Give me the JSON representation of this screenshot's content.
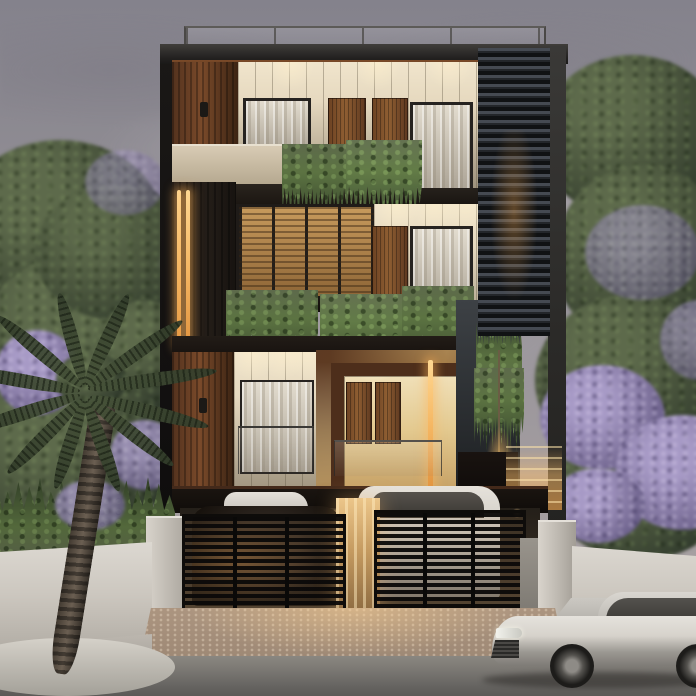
{
  "scene": {
    "type": "3d-architectural-render",
    "time_of_day": "dusk",
    "subject": "Modern three-storey residence with walnut wood panels, cream battened walls and a dark horizontal louver screen; rooftop glass railing; vine-draped balconies with warm interior lighting; gated stilt parking with cars; flanked by a palm tree and purple flowering trees behind a concrete compound wall; a silver sedan parked on the street.",
    "elements": {
      "sky": "overcast mauve dusk sky",
      "building": "modern 3-storey residence",
      "roof_railing": "rooftop glass railing",
      "louver_screen": "dark horizontal louver screen",
      "balcony_vines": "hanging balcony planter vines",
      "wood_feature_box": "walnut entrance box with lit interior",
      "led_strips": "amber vertical LED strip lights",
      "parking_gates": "black slatted driveway gates",
      "parked_cars": "cars inside stilt parking",
      "street_car": "silver sedan parked on street",
      "palm_tree": "palm tree at sidewalk",
      "flowering_trees": "purple flowering trees",
      "compound_wall": "light concrete compound wall",
      "driveway": "paver driveway",
      "street": "asphalt road"
    }
  },
  "colors": {
    "sky-top": "#84828c",
    "sky-mid": "#98949a",
    "sky-low": "#aba4a4",
    "cream": "#e6d9bf",
    "cream-deep": "#b5a78c",
    "wood": "#7a4a2a",
    "wood-dark": "#53321e",
    "wood-deep": "#3c2413",
    "panel-dark": "#221c17",
    "slate": "#3d4145",
    "slate-dark": "#26292c",
    "louver-hi": "#454a52",
    "louver-lo": "#101214",
    "amber": "#f5b763",
    "glow": "#e9a851",
    "frame": "#262320",
    "curtain": "#d3cbbd",
    "vine": "#5c7342",
    "vine-dark": "#34422a",
    "leaf": "#47523b",
    "leaf-dark": "#2d372a",
    "leaf-light": "#5d6a4b",
    "purple": "#8276a0",
    "purple-light": "#a79ac6",
    "concrete": "#ccc7bf",
    "concrete-dark": "#9d9890",
    "paver": "#ac9580",
    "paver-lit": "#d9bf9e",
    "asphalt": "#7d7a75",
    "asphalt-dark": "#5c5a57",
    "car": "#d6d2cb",
    "car-dark": "#8a8680",
    "interior": "#f0dfb5",
    "gate": "#0e0c0a"
  }
}
